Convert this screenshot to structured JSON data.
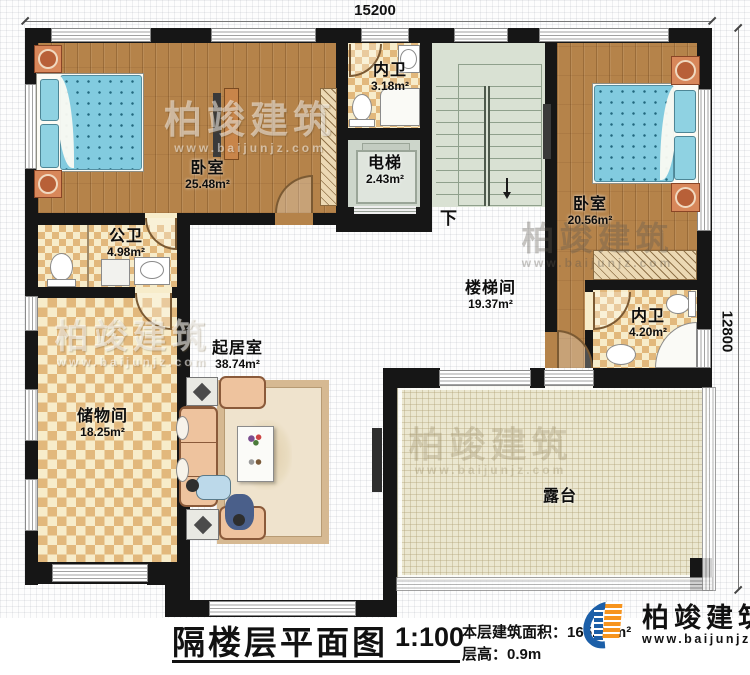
{
  "dimensions": {
    "top": "15200",
    "right": "12800"
  },
  "rooms": [
    {
      "name": "卧室",
      "area": "25.48m²"
    },
    {
      "name": "内卫",
      "area": "3.18m²"
    },
    {
      "name": "电梯",
      "area": "2.43m²"
    },
    {
      "name": "卧室",
      "area": "20.56m²"
    },
    {
      "name": "公卫",
      "area": "4.98m²"
    },
    {
      "name": "楼梯间",
      "area": "19.37m²"
    },
    {
      "name": "内卫",
      "area": "4.20m²"
    },
    {
      "name": "起居室",
      "area": "38.74m²"
    },
    {
      "name": "储物间",
      "area": "18.25m²"
    },
    {
      "name": "露台",
      "area": ""
    }
  ],
  "stairs": {
    "down_label": "下"
  },
  "title_block": {
    "title": "隔楼层平面图",
    "scale": "1:100",
    "floor_area_label": "本层建筑面积：",
    "floor_area_value": "165.50m²",
    "floor_height_label": "层高：",
    "floor_height_value": "0.9m"
  },
  "brand": {
    "name": "柏竣建筑",
    "website": "www.baijunjz.com"
  },
  "watermark": {
    "name": "柏竣建筑",
    "website": "www.baijunjz.com"
  },
  "colors": {
    "wall": "#161616",
    "wood_floor": "#b5834a",
    "tile_light": "#f7ecca",
    "tile_dark": "#e2b87c",
    "stair_floor": "#d9e1d3",
    "terrace_floor": "#ebe7d0",
    "bed_blanket": "#82cbdf",
    "sofa": "#eec39e",
    "logo_blue": "#1c5fa8",
    "logo_orange": "#f7941d"
  }
}
